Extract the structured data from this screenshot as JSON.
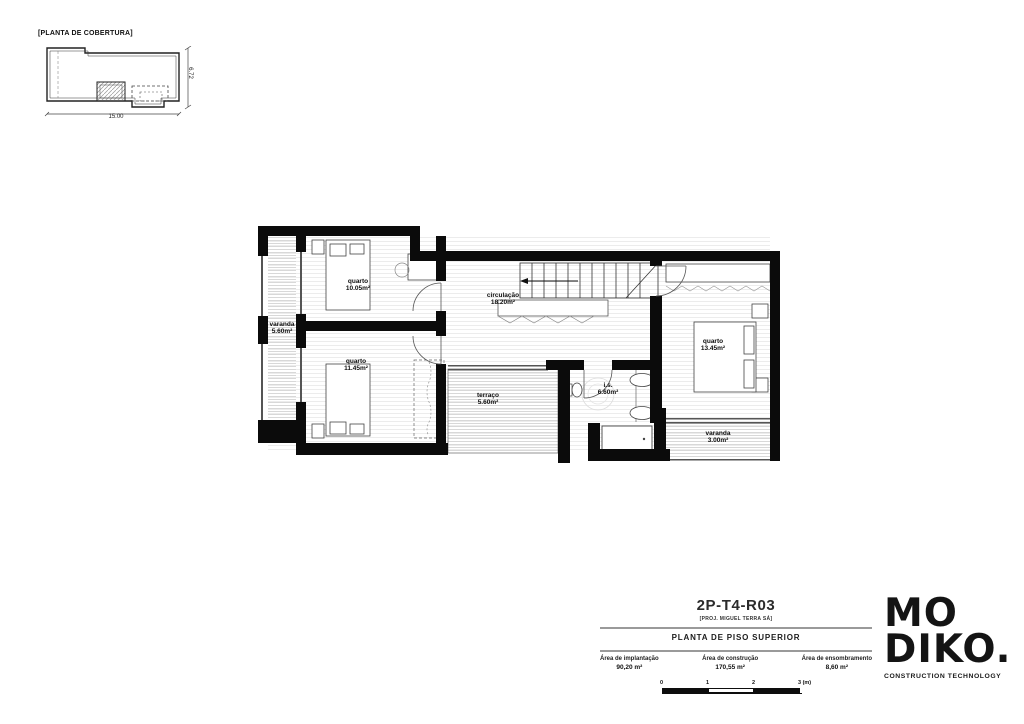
{
  "roof_plan": {
    "title": "[PLANTA DE COBERTURA]",
    "dim_horizontal": "15.00",
    "dim_vertical": "6.72"
  },
  "floor_plan": {
    "rooms": [
      {
        "name": "varanda",
        "area": "5.60m²"
      },
      {
        "name": "quarto",
        "area": "10.05m²"
      },
      {
        "name": "quarto",
        "area": "11.45m²"
      },
      {
        "name": "circulação",
        "area": "18.20m²"
      },
      {
        "name": "terraço",
        "area": "5.60m²"
      },
      {
        "name": "i.s.",
        "area": "6.60m²"
      },
      {
        "name": "quarto",
        "area": "13.45m²"
      },
      {
        "name": "varanda",
        "area": "3.00m²"
      }
    ]
  },
  "title_block": {
    "code": "2P-T4-R03",
    "author": "[PROJ. MIGUEL TERRA SÁ]",
    "drawing_title": "PLANTA DE PISO SUPERIOR",
    "areas": [
      {
        "label": "Área de implantação",
        "value": "90,20 m²"
      },
      {
        "label": "Área de construção",
        "value": "170,55 m²"
      },
      {
        "label": "Área de ensombramento",
        "value": "8,60 m²"
      }
    ],
    "scale_ticks": [
      "0",
      "1",
      "2",
      "3 (m)"
    ]
  },
  "logo": {
    "line1": "MO",
    "line2": "DIKO.",
    "tagline": "CONSTRUCTION TECHNOLOGY"
  },
  "colors": {
    "ink": "#0b0b0b",
    "paper": "#ffffff"
  }
}
